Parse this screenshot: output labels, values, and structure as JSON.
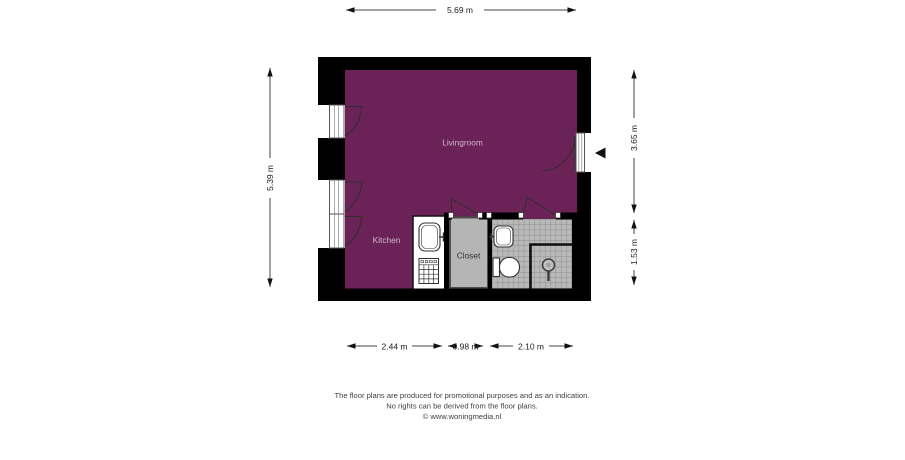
{
  "dimensions": {
    "top": "5.69 m",
    "left": "5.39 m",
    "right_upper": "3.65 m",
    "right_lower": "1.53 m",
    "bottom_left": "2.44 m",
    "bottom_middle": "0.98 m",
    "bottom_right": "2.10 m"
  },
  "rooms": {
    "livingroom": "Livingroom",
    "kitchen": "Kitchen",
    "closet": "Closet"
  },
  "footer": {
    "line1": "The floor plans are produced for promotional purposes and as an indication.",
    "line2": "No rights can be derived from the floor plans.",
    "line3": "© www.woningmedia.nl"
  },
  "colors": {
    "room_fill": "#6b2257",
    "wall": "#000000",
    "closet_fill": "#b5b5b5",
    "tile_fill": "#b9b9b9",
    "tile_line": "#8d8d8d",
    "label_light": "#cdb7c8",
    "label_dark": "#333333"
  }
}
